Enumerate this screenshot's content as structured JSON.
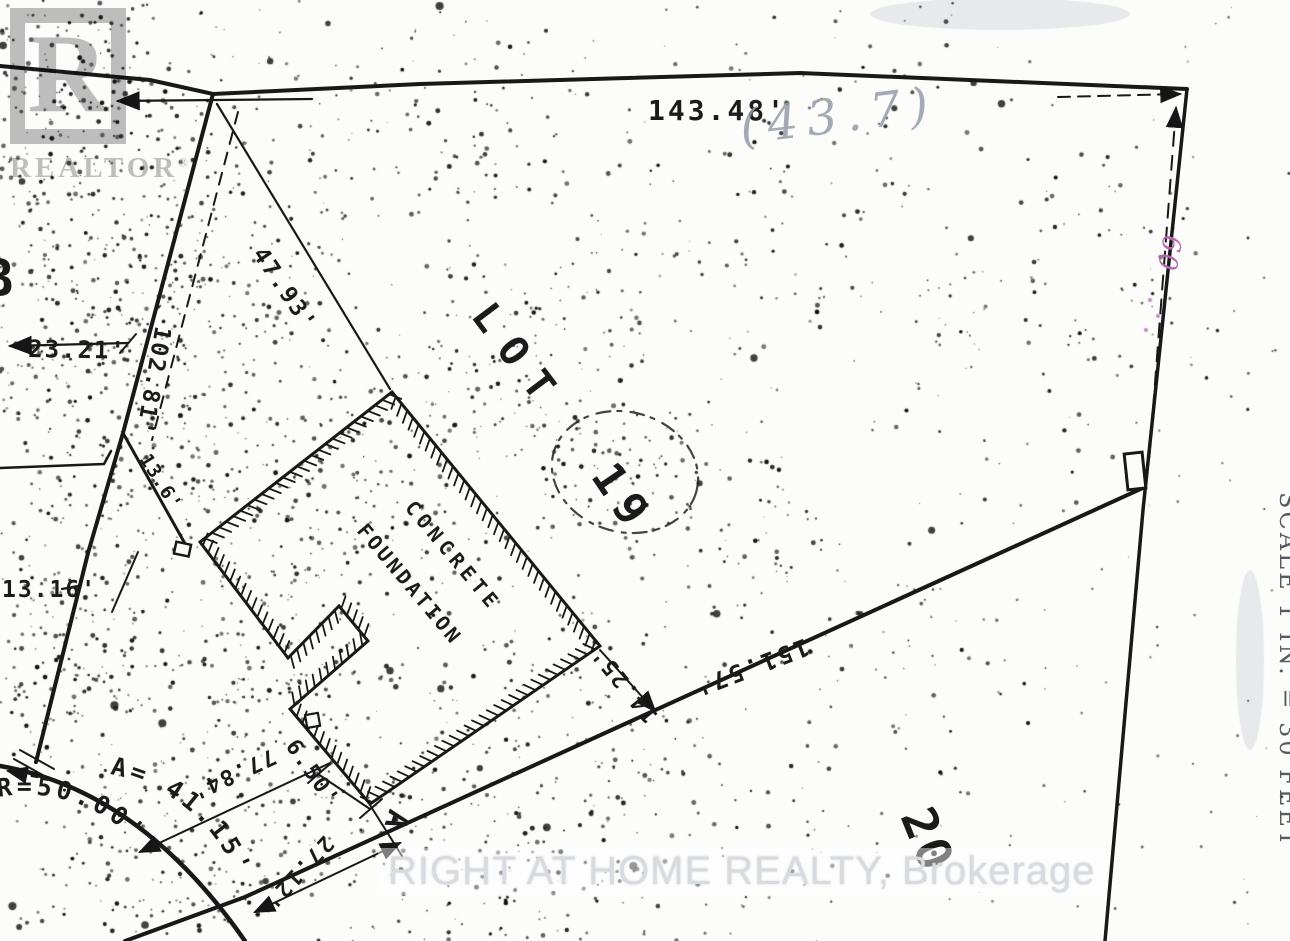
{
  "document": {
    "kind": "scanned survey sketch of building lot"
  },
  "watermarks": {
    "realtor_letter": "R",
    "realtor_word": "REALTOR",
    "registered": "®",
    "brokerage": "RIGHT AT HOME REALTY, Brokerage"
  },
  "annotations": {
    "scale_note": "SCALE 1 IN. = 30 FEET",
    "handwritten_top": "(43.7)",
    "handwritten_pink": "60"
  },
  "plan": {
    "lot_title": "LOT 19",
    "labels": [
      {
        "id": "dim_top",
        "text": "143.48'"
      },
      {
        "id": "dim_4793",
        "text": "47.93'"
      },
      {
        "id": "dim_2321",
        "text": "23.21'"
      },
      {
        "id": "dim_10281",
        "text": "102.81'"
      },
      {
        "id": "dim_1316",
        "text": "13.16'"
      },
      {
        "id": "dim_136",
        "text": "13.6'"
      },
      {
        "id": "lot_word",
        "text": "LOT"
      },
      {
        "id": "lot_num",
        "text": "19"
      },
      {
        "id": "concrete",
        "text": "CONCRETE"
      },
      {
        "id": "foundation",
        "text": "FOUNDATION"
      },
      {
        "id": "dim_1425",
        "text": "14.25'"
      },
      {
        "id": "dim_15157",
        "text": "151.57'"
      },
      {
        "id": "dim_7784",
        "text": "77.84'"
      },
      {
        "id": "dim_650",
        "text": "6.50'"
      },
      {
        "id": "dim_2712",
        "text": "27.12'"
      },
      {
        "id": "point_A",
        "text": "A"
      },
      {
        "id": "lot_b",
        "text": "B"
      },
      {
        "id": "lot20",
        "text": "20"
      },
      {
        "id": "dim_r50",
        "text": "R=50.00'"
      },
      {
        "id": "dim_a4115",
        "text": "A= 41.15'"
      }
    ]
  }
}
